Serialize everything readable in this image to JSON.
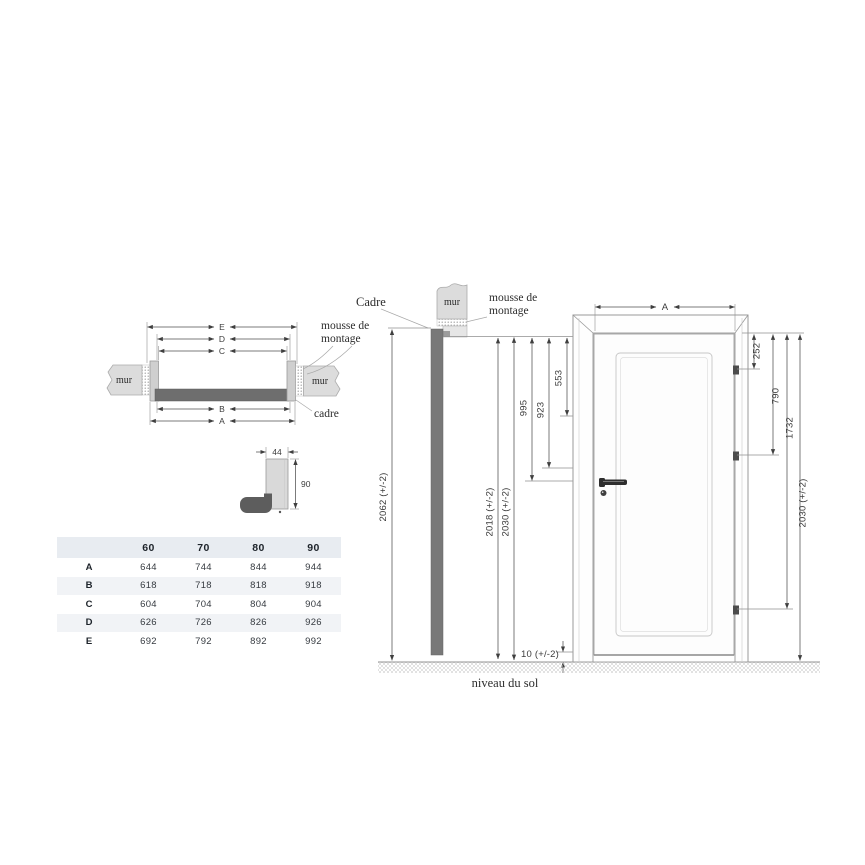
{
  "plan_section": {
    "dim_e": "E",
    "dim_d": "D",
    "dim_c": "C",
    "dim_b": "B",
    "dim_a": "A",
    "mur_left": "mur",
    "mur_right": "mur",
    "mousse_line1": "mousse de",
    "mousse_line2": "montage",
    "cadre": "cadre"
  },
  "profile_detail": {
    "dim_width": "44",
    "dim_height": "90"
  },
  "vertical_section": {
    "cadre": "Cadre",
    "mur": "mur",
    "mousse_line1": "mousse de",
    "mousse_line2": "montage",
    "dim_total": "2062 (+/-2)",
    "dim_inner": "2018 (+/-2)",
    "dim_opening": "2030 (+/-2)",
    "dim_handle": "995",
    "dim_lock": "923",
    "dim_upper": "553",
    "dim_floor_gap": "10 (+/-2)",
    "ground_label": "niveau du sol"
  },
  "elevation": {
    "dim_width": "A",
    "dim_hinge_top": "252",
    "dim_hinge_middle": "790",
    "dim_hinge_bottom": "1732",
    "dim_total_height": "2030 (+/-2)"
  },
  "size_table": {
    "column_headers": [
      "60",
      "70",
      "80",
      "90"
    ],
    "rows": [
      {
        "label": "A",
        "values": [
          "644",
          "744",
          "844",
          "944"
        ]
      },
      {
        "label": "B",
        "values": [
          "618",
          "718",
          "818",
          "918"
        ]
      },
      {
        "label": "C",
        "values": [
          "604",
          "704",
          "804",
          "904"
        ]
      },
      {
        "label": "D",
        "values": [
          "626",
          "726",
          "826",
          "926"
        ]
      },
      {
        "label": "E",
        "values": [
          "692",
          "792",
          "892",
          "992"
        ]
      }
    ]
  },
  "colors": {
    "frame_dark": "#6e6e6e",
    "wall_gray": "#dcdcdc",
    "table_header_bg": "#e8ecf1",
    "table_alt_row_bg": "#f1f3f6",
    "outline": "#9a9a9a",
    "dim_text": "#3c3c3c"
  }
}
